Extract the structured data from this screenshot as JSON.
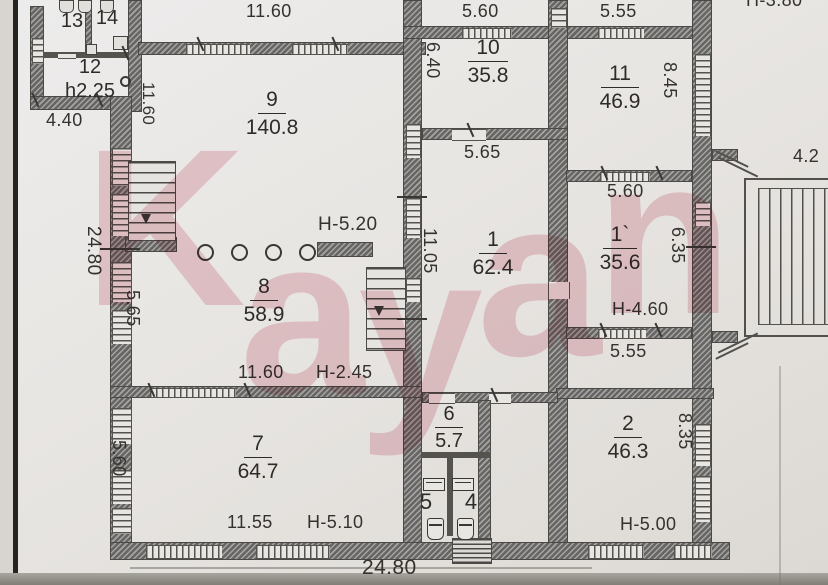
{
  "watermark": {
    "text": "Kayan"
  },
  "colors": {
    "watermark_pink": "#eab6c2",
    "wall_gray": "#7e7d7b",
    "paper": "#e8e6e2"
  },
  "rooms": {
    "r13": {
      "num": "13"
    },
    "r14": {
      "num": "14"
    },
    "r12": {
      "num": "12",
      "h": "h2.25"
    },
    "r9": {
      "num": "9",
      "area": "140.8"
    },
    "r10": {
      "num": "10",
      "area": "35.8"
    },
    "r11": {
      "num": "11",
      "area": "46.9"
    },
    "r1": {
      "num": "1",
      "area": "62.4"
    },
    "r1p": {
      "num": "1`",
      "area": "35.6"
    },
    "r8": {
      "num": "8",
      "area": "58.9"
    },
    "r7": {
      "num": "7",
      "area": "64.7"
    },
    "r6": {
      "num": "6",
      "area": "5.7"
    },
    "r5": {
      "num": "5"
    },
    "r4": {
      "num": "4"
    },
    "r2": {
      "num": "2",
      "area": "46.3"
    }
  },
  "dims": {
    "top_9": "11.60",
    "top_10": "5.60",
    "top_11": "5.55",
    "top_right_cut": "Н-3.80",
    "left_24_80": "24.80",
    "left_11_60": "11.60",
    "left_5_65": "5.65",
    "left_5_60": "5.60",
    "annex_4_40": "4.40",
    "v_6_40": "6.40",
    "v_8_45": "8.45",
    "v_11_05": "11.05",
    "v_6_35": "6.35",
    "v_8_35": "8.35",
    "below_10": "5.65",
    "below_11": "5.60",
    "below_1p": "5.55",
    "mid_11_60": "11.60",
    "bottom_7": "11.55",
    "bottom_24_80": "24.80",
    "stair_4_2": "4.2"
  },
  "heights": {
    "h8": "Н-5.20",
    "h8b": "Н-2.45",
    "h7": "Н-5.10",
    "h1p": "Н-4.60",
    "h2": "Н-5.00"
  }
}
